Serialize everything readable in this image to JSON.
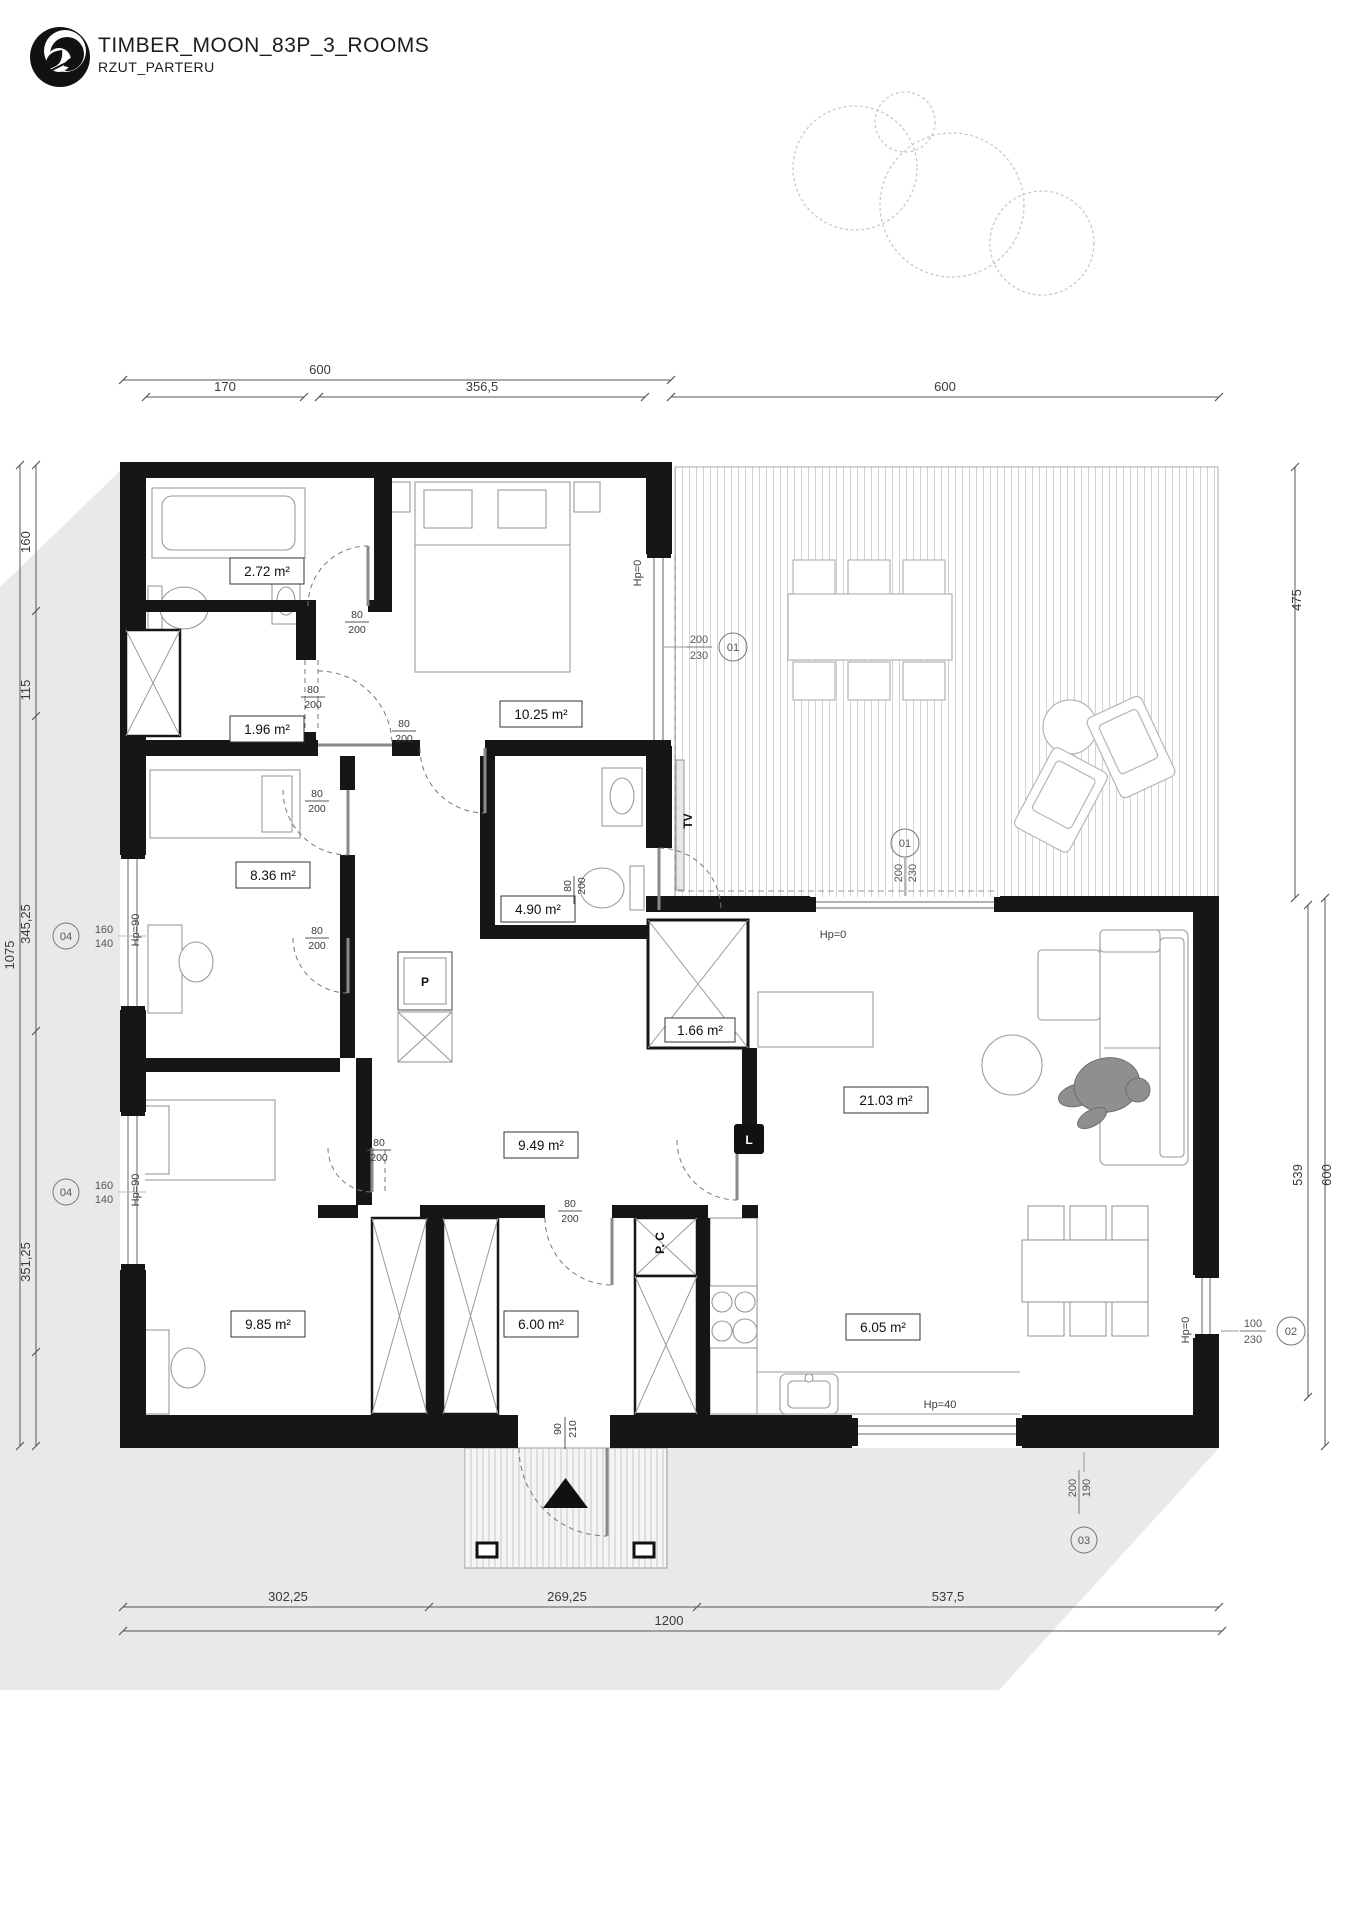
{
  "header": {
    "title": "TIMBER_MOON_83P_3_ROOMS",
    "subtitle": "RZUT_PARTERU"
  },
  "colors": {
    "wall": "#161616",
    "site_shadow": "#e9e9e9",
    "dimension": "#555555",
    "furniture": "#9a9a9a",
    "hatch": "#d2d2d2",
    "accent_black": "#111111"
  },
  "dims": {
    "top": [
      {
        "label": "600"
      },
      {
        "label": "170"
      },
      {
        "label": "356,5"
      },
      {
        "label": "600"
      }
    ],
    "left": [
      {
        "label": "160"
      },
      {
        "label": "115"
      },
      {
        "label": "345,25"
      },
      {
        "label": "351,25"
      },
      {
        "label": "1075"
      }
    ],
    "right": [
      {
        "label": "475"
      },
      {
        "label": "539"
      },
      {
        "label": "600"
      }
    ],
    "bottom": [
      {
        "label": "302,25"
      },
      {
        "label": "269,25"
      },
      {
        "label": "537,5"
      },
      {
        "label": "1200"
      }
    ]
  },
  "rooms": [
    {
      "label": "2.72 m²"
    },
    {
      "label": "1.96 m²"
    },
    {
      "label": "10.25 m²"
    },
    {
      "label": "8.36 m²"
    },
    {
      "label": "4.90 m²"
    },
    {
      "label": "1.66 m²"
    },
    {
      "label": "9.49 m²"
    },
    {
      "label": "21.03 m²"
    },
    {
      "label": "9.85 m²"
    },
    {
      "label": "6.00 m²"
    },
    {
      "label": "6.05 m²"
    }
  ],
  "doors": [
    {
      "top": "80",
      "bottom": "200"
    },
    {
      "top": "80",
      "bottom": "200"
    },
    {
      "top": "80",
      "bottom": "200"
    },
    {
      "top": "80",
      "bottom": "200"
    },
    {
      "top": "80",
      "bottom": "200"
    },
    {
      "top": "80",
      "bottom": "200"
    },
    {
      "top": "80",
      "bottom": "200"
    },
    {
      "top": "80",
      "bottom": "200"
    },
    {
      "top": "90",
      "bottom": "210"
    }
  ],
  "win_markers": [
    {
      "code": "01",
      "w": "200",
      "h": "230"
    },
    {
      "code": "01",
      "w": "200",
      "h": "230"
    },
    {
      "code": "02",
      "w": "100",
      "h": "230"
    },
    {
      "code": "03",
      "w": "200",
      "h": "190"
    },
    {
      "code": "04",
      "w": "160",
      "h": "140"
    },
    {
      "code": "04",
      "w": "160",
      "h": "140"
    }
  ],
  "sills": [
    {
      "label": "Hp=0"
    },
    {
      "label": "Hp=0"
    },
    {
      "label": "Hp=0"
    },
    {
      "label": "Hp=40"
    },
    {
      "label": "Hp=90"
    },
    {
      "label": "Hp=90"
    }
  ],
  "appliances": {
    "tv": "TV",
    "fridge": "L",
    "washer": "P",
    "boiler": "P. C"
  }
}
